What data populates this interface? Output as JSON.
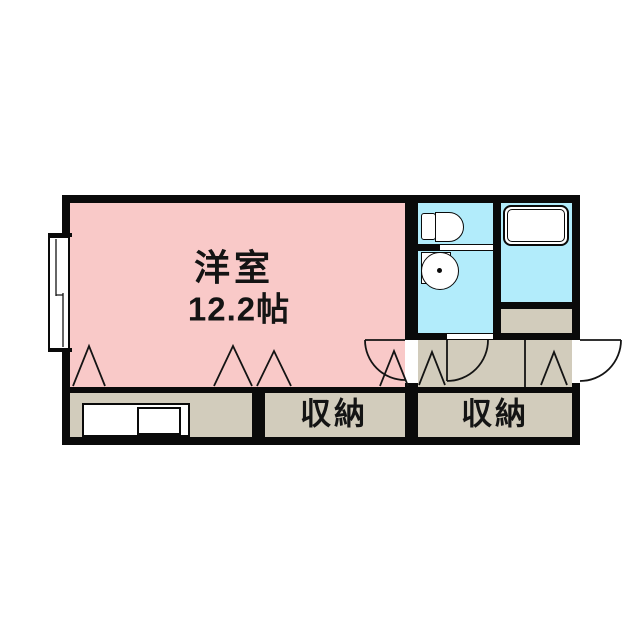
{
  "plan": {
    "type": "floor-plan",
    "rooms": {
      "main": {
        "name": "洋室",
        "size": "12.2帖"
      },
      "storage_center": {
        "name": "収納"
      },
      "storage_right": {
        "name": "収納"
      },
      "toilet": {
        "name": ""
      },
      "washroom": {
        "name": ""
      },
      "bathroom": {
        "name": ""
      },
      "kitchen": {
        "name": ""
      },
      "entry": {
        "name": ""
      }
    },
    "fixture_icons": [
      "toilet-icon",
      "washbasin-icon",
      "bathtub-icon",
      "kitchen-counter",
      "sliding-window-icon",
      "hinged-door-icon",
      "folding-door-mark"
    ],
    "folding_door_mark_count": 6,
    "hinged_door_count": 3
  },
  "colors": {
    "main_room_pink": "#f9c9c8",
    "wet_area_blue": "#b2ecfb",
    "floor_tan": "#d2ccbc",
    "wall_black": "#0a0a0a",
    "fixture_white": "#ffffff"
  }
}
